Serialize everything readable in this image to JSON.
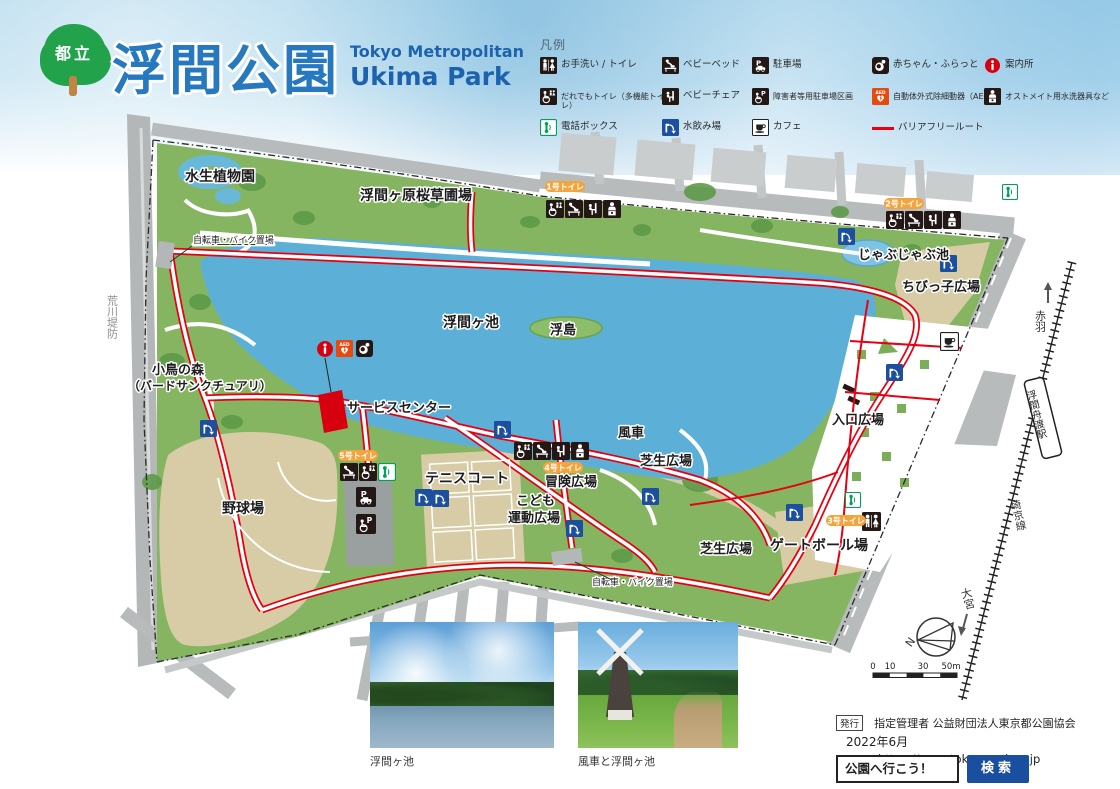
{
  "header": {
    "badge": "都立",
    "title": "浮間公園",
    "subtitle_line1": "Tokyo Metropolitan",
    "subtitle_line2": "Ukima Park"
  },
  "legend": {
    "title": "凡例",
    "items": [
      {
        "icon": "toilet-icon",
        "label": "お手洗い / トイレ"
      },
      {
        "icon": "accessible-toilet-icon",
        "label": "だれでもトイレ（多機能トイレ）"
      },
      {
        "icon": "phone-booth-icon",
        "label": "電話ボックス"
      },
      {
        "icon": "baby-bed-icon",
        "label": "ベビーベッド"
      },
      {
        "icon": "baby-chair-icon",
        "label": "ベビーチェア"
      },
      {
        "icon": "drinking-fountain-icon",
        "label": "水飲み場"
      },
      {
        "icon": "parking-icon",
        "label": "駐車場"
      },
      {
        "icon": "accessible-parking-icon",
        "label": "障害者等用駐車場区画"
      },
      {
        "icon": "cafe-icon",
        "label": "カフェ"
      },
      {
        "icon": "baby-rest-icon",
        "label": "赤ちゃん・ふらっと"
      },
      {
        "icon": "aed-icon",
        "label": "自動体外式除細動器（AED）"
      },
      {
        "icon": "barrier-free-route-swatch",
        "label": "バリアフリールート"
      },
      {
        "icon": "information-icon",
        "label": "案内所"
      },
      {
        "icon": "ostomate-icon",
        "label": "オストメイト用水洗器具など"
      }
    ]
  },
  "map": {
    "labels": {
      "aquatic_garden": "水生植物園",
      "sakuraso_field": "浮間ヶ原桜草圃場",
      "bike_parking_1": "自転車・バイク置場",
      "bike_parking_2": "自転車・バイク置場",
      "lake": "浮間ヶ池",
      "floating_island": "浮島",
      "bird_forest_1": "小鳥の森",
      "bird_forest_2": "（バードサンクチュアリ）",
      "service_center": "サービスセンター",
      "baseball": "野球場",
      "tennis": "テニスコート",
      "kids_sports_1": "こども",
      "kids_sports_2": "運動広場",
      "adventure": "冒険広場",
      "windmill": "風車",
      "lawn_1": "芝生広場",
      "lawn_2": "芝生広場",
      "gateball": "ゲートボール場",
      "entrance": "入口広場",
      "jabujabu": "じゃぶじゃぶ池",
      "chibikko": "ちびっ子広場",
      "levee": "荒川堤防",
      "station": "浮間舟渡駅",
      "to_akabane": "赤羽",
      "to_omiya": "大宮",
      "rail_line": "埼京線"
    },
    "toilets": {
      "t1": "1号トイレ",
      "t2": "2号トイレ",
      "t3": "3号トイレ",
      "t4": "4号トイレ",
      "t5": "5号トイレ"
    },
    "compass": "N",
    "scale": {
      "t0": "0",
      "t10": "10",
      "t30": "30",
      "t50": "50m"
    }
  },
  "photos": [
    {
      "caption": "浮間ヶ池"
    },
    {
      "caption": "風車と浮間ヶ池"
    }
  ],
  "footer": {
    "issue": "発行",
    "publisher": "指定管理者 公益財団法人東京都公園協会",
    "date": "2022年6月",
    "url": "https://www.tokyo-park.or.jp"
  },
  "search": {
    "query": "公園へ行こう！",
    "button": "検索"
  }
}
